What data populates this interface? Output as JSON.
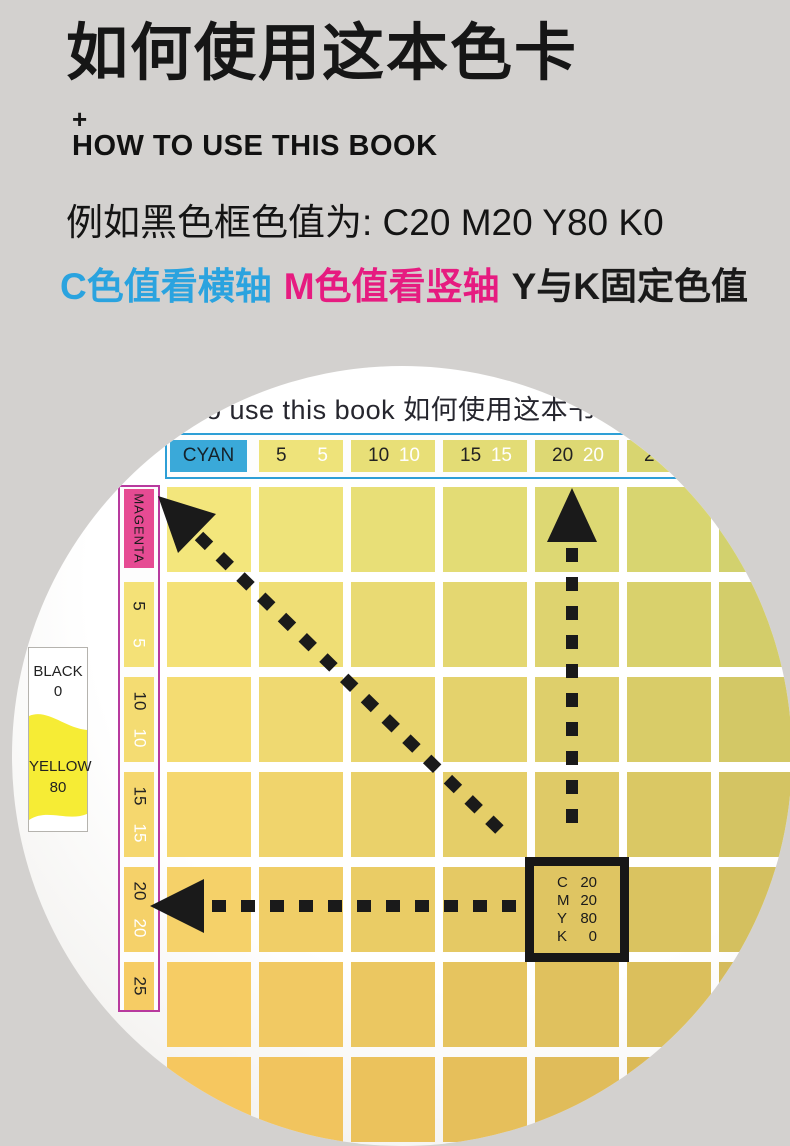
{
  "page": {
    "background": "#d3d1cf"
  },
  "intro": {
    "title": "如何使用这本色卡",
    "plus": "+",
    "subtitle": "HOW TO USE THIS BOOK",
    "example": "例如黑色框色值为: C20 M20 Y80 K0",
    "legend": [
      {
        "text": "C色值看横轴",
        "color": "#2aa3df"
      },
      {
        "text": "M色值看竖轴",
        "color": "#e61b80"
      },
      {
        "text": "Y与K固定色值",
        "color": "#1a1a1a"
      }
    ]
  },
  "photo": {
    "page_header": "to use this book  如何使用这本书",
    "cyan_axis": {
      "label": "CYAN",
      "badge_color": "#3aa9d9",
      "border_color": "#2e9fd6",
      "cells": [
        {
          "black": "5",
          "white": "5"
        },
        {
          "black": "10",
          "white": "10"
        },
        {
          "black": "15",
          "white": "15"
        },
        {
          "black": "20",
          "white": "20"
        },
        {
          "black": "25",
          "white": "25"
        }
      ]
    },
    "magenta_axis": {
      "label": "MAGENTA",
      "badge_color": "#e64b93",
      "border_color": "#b83a9e",
      "cells": [
        {
          "black": "5",
          "white": "5"
        },
        {
          "black": "10",
          "white": "10"
        },
        {
          "black": "15",
          "white": "15"
        },
        {
          "black": "20",
          "white": "20"
        },
        {
          "black": "25",
          "white": "25"
        }
      ]
    },
    "tab": {
      "top_label": "BLACK",
      "top_value": "0",
      "bottom_label": "YELLOW",
      "bottom_value": "80",
      "swatch_color": "#f6ec35"
    },
    "grid": {
      "rows": 7,
      "cols": 7,
      "corner_colors": {
        "tl": "#f3e67c",
        "tr": "#d2d16e",
        "bl": "#f6c75f",
        "br": "#d5b757"
      }
    },
    "target": {
      "rows": [
        {
          "channel": "C",
          "value": "20"
        },
        {
          "channel": "M",
          "value": "20"
        },
        {
          "channel": "Y",
          "value": "80"
        },
        {
          "channel": "K",
          "value": "0"
        }
      ],
      "grid_row": 5,
      "grid_col": 5
    }
  }
}
